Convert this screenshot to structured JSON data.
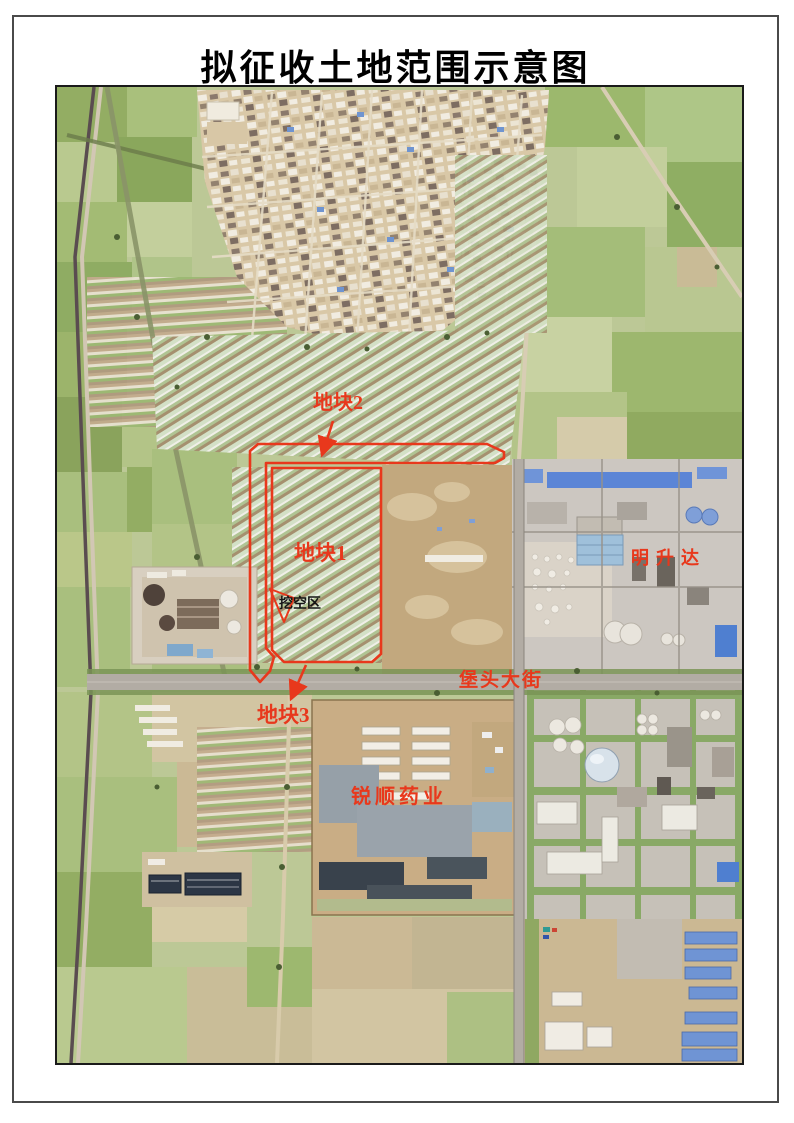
{
  "page": {
    "title": "拟征收土地范围示意图"
  },
  "map": {
    "labels": {
      "parcel1": "地块1",
      "parcel2": "地块2",
      "parcel3": "地块3",
      "excavation_zone": "挖空区",
      "company_northeast": "明升达",
      "street": "堡头大街",
      "company_south": "锐顺药业"
    },
    "annotation_color": "#e8381c",
    "excavation_text_color": "#141414"
  }
}
